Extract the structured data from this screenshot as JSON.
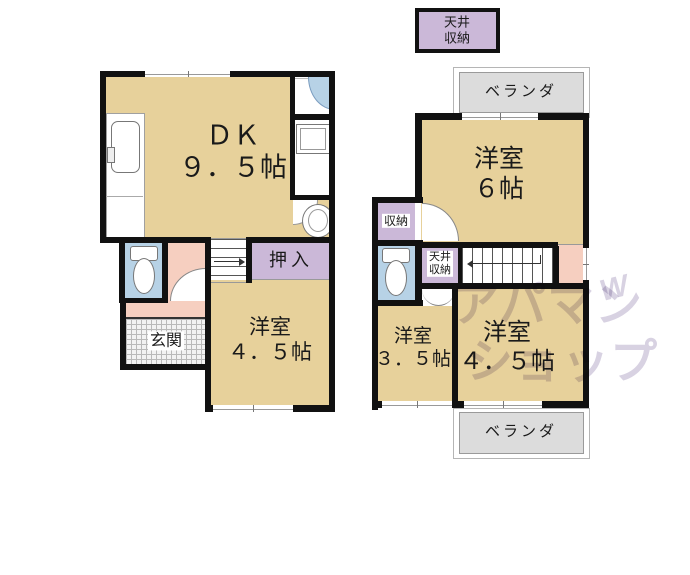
{
  "attic_box": {
    "line1": "天井",
    "line2": "収納"
  },
  "floor1": {
    "dk": {
      "name": "ＤＫ",
      "size": "９．５帖"
    },
    "closet_label": "押入",
    "room_45": {
      "name": "洋室",
      "size": "４．５帖"
    },
    "entrance_label": "玄関"
  },
  "floor2": {
    "veranda_top": "ベランダ",
    "room_6": {
      "name": "洋室",
      "size": "６帖"
    },
    "closet_label": "収納",
    "ceiling_storage": {
      "line1": "天井",
      "line2": "収納"
    },
    "room_35": {
      "name": "洋室",
      "size": "３．５帖"
    },
    "room_45": {
      "name": "洋室",
      "size": "４．５帖"
    },
    "veranda_bottom": "ベランダ"
  },
  "watermark": {
    "line1": "アパマン",
    "line2": "ショップ",
    "mark": "W"
  },
  "colors": {
    "room_fill": "#e7d19b",
    "closet_fill": "#cbb8d8",
    "hallway_fill": "#f6cfc0",
    "toilet_fill": "#b7d2e6",
    "veranda_fill": "#dcdcdc",
    "wall": "#111111",
    "watermark": "#d8d2e2"
  }
}
